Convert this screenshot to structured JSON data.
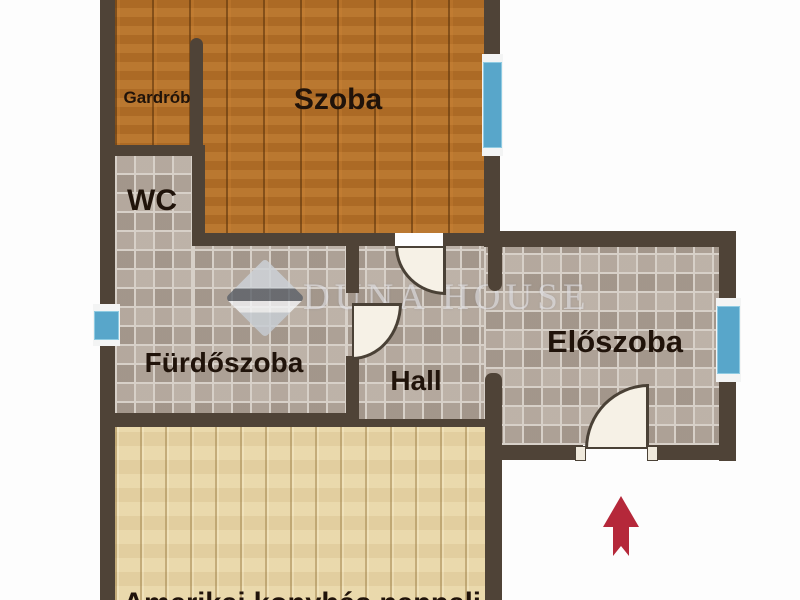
{
  "plan": {
    "rooms": {
      "gardrob": {
        "label": "Gardrób"
      },
      "szoba": {
        "label": "Szoba"
      },
      "wc": {
        "label": "WC"
      },
      "furdoszoba": {
        "label": "Fürdőszoba"
      },
      "hall": {
        "label": "Hall"
      },
      "eloszoba": {
        "label": "Előszoba"
      },
      "nappali": {
        "label": "Amerikai konyhás nappali"
      }
    },
    "watermark": {
      "text": "DUNA HOUSE"
    },
    "colors": {
      "wall": "#4f4337",
      "window_glass": "#58a6ca",
      "entrance_arrow": "#b5283a",
      "floor_wood_dark": "#b26f28",
      "floor_wood_light": "#e8d5a6",
      "floor_tile": "#b3a89d",
      "label_text": "#20130a"
    }
  }
}
